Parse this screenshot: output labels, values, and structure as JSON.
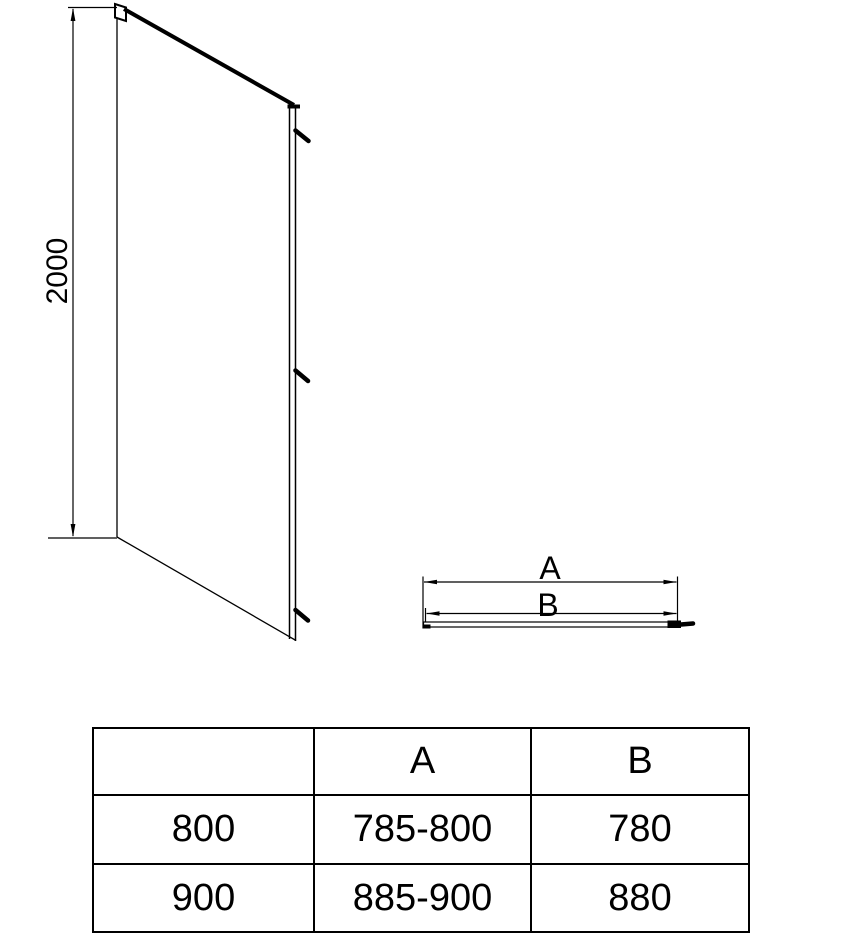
{
  "drawing": {
    "height_dimension_label": "2000",
    "dimension_a_label": "A",
    "dimension_b_label": "B"
  },
  "table": {
    "headers": [
      "",
      "A",
      "B"
    ],
    "rows": [
      [
        "800",
        "785-800",
        "780"
      ],
      [
        "900",
        "885-900",
        "880"
      ]
    ]
  },
  "colors": {
    "line": "#000000",
    "background": "#ffffff",
    "text": "#000000"
  }
}
